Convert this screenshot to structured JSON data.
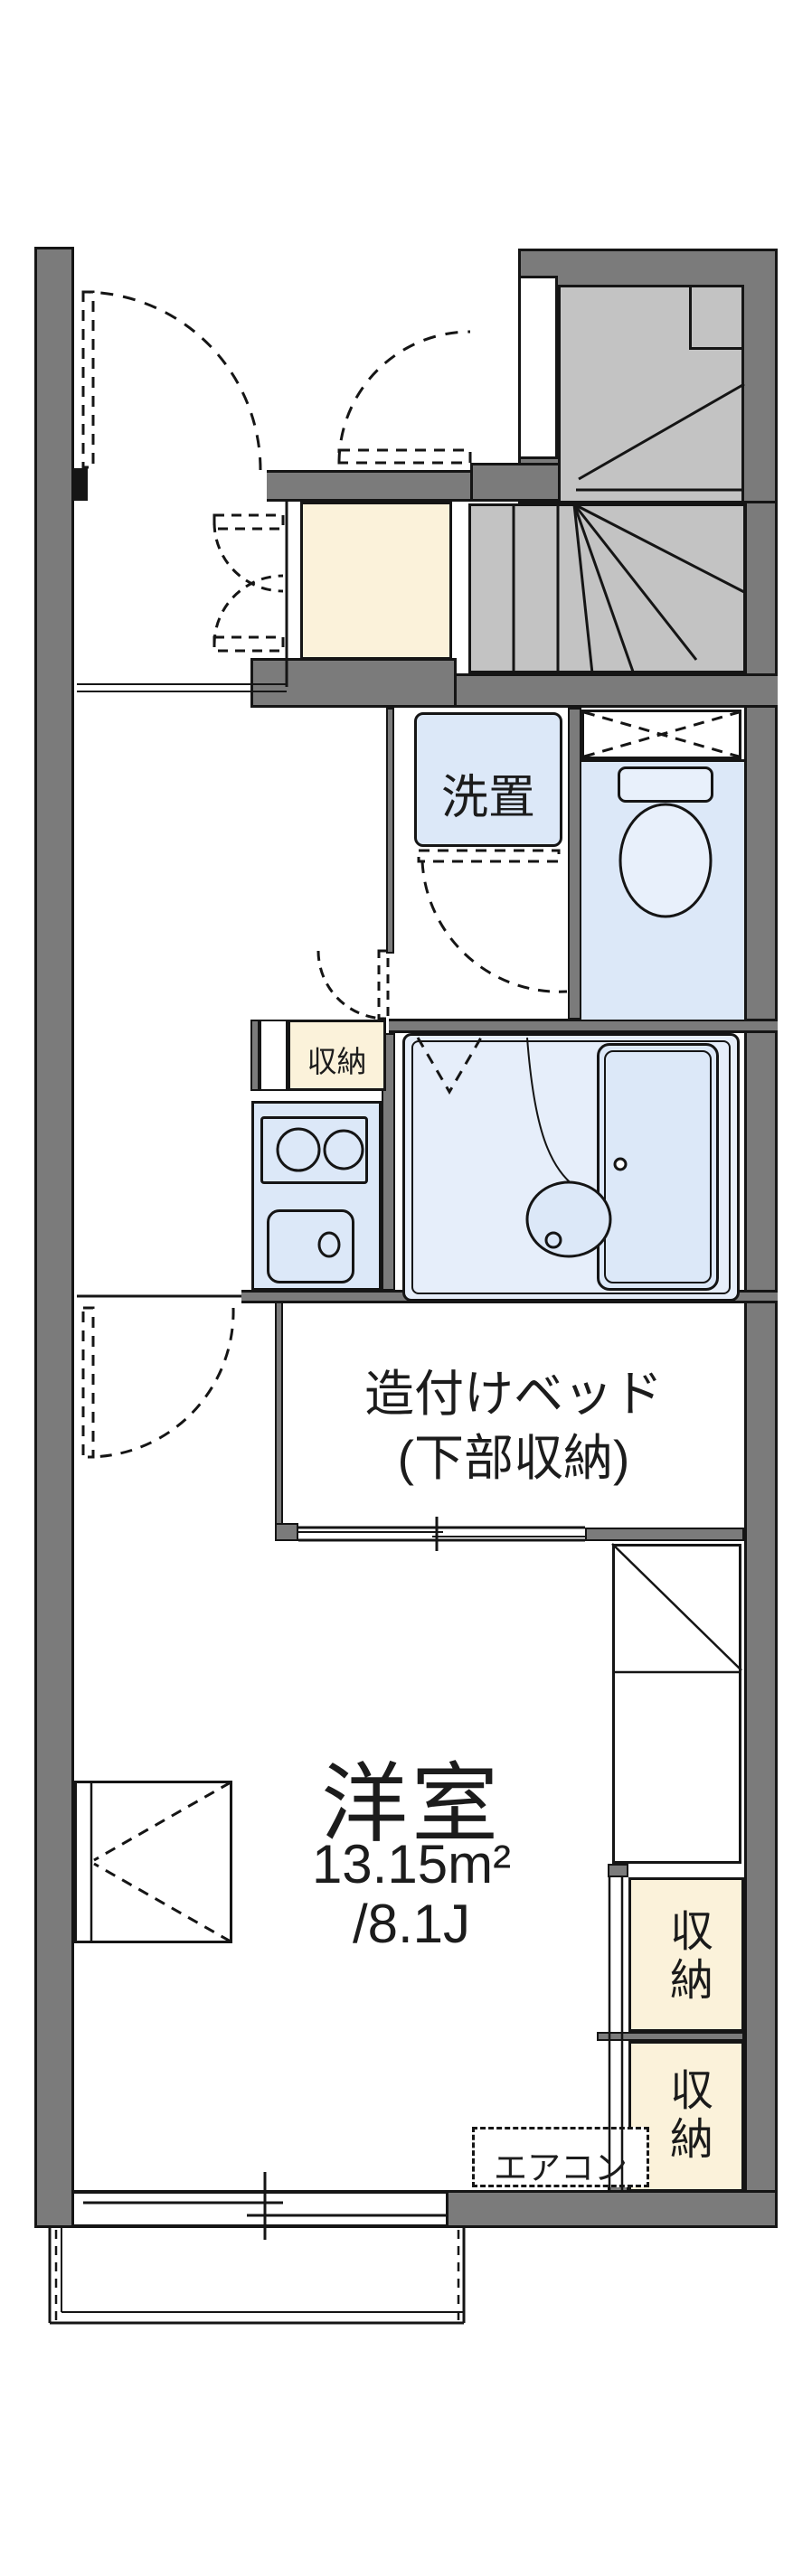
{
  "plan_labels": {
    "washer": "洗置",
    "storage_mid": "収納",
    "bed_line1": "造付けベッド",
    "bed_line2": "(下部収納)",
    "room_name": "洋室",
    "room_area": "13.15m²",
    "room_tatami": "/8.1J",
    "closet_top": "収納",
    "closet_bottom": "収納",
    "aircon": "エアコン"
  },
  "colors": {
    "wall": "#7b7b7b",
    "stair": "#c3c3c3",
    "cream": "#fbf2da",
    "fixture": "#dce8f8",
    "bath": "#e6eefa",
    "line": "#151515"
  }
}
